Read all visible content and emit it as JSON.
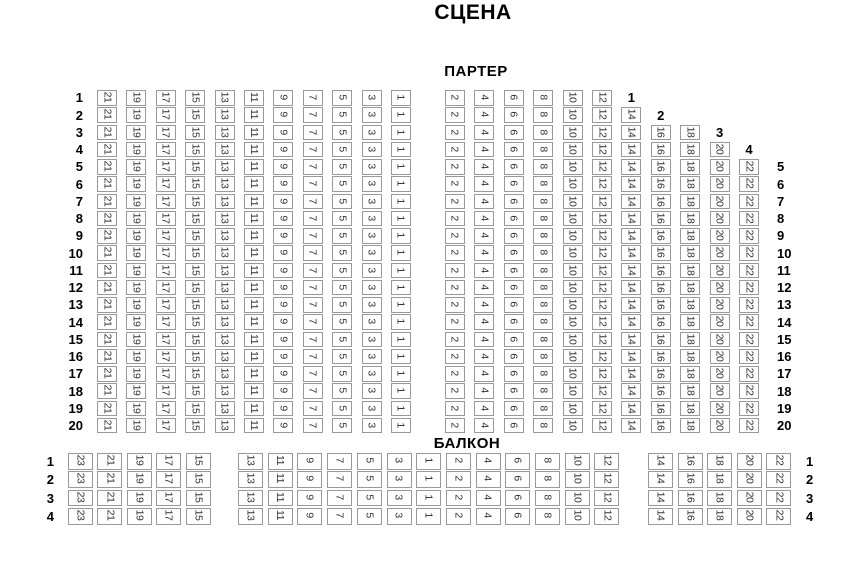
{
  "stage": {
    "label": "СЦЕНА"
  },
  "parterre": {
    "label": "ПАРТЕР",
    "left_row_labels": [
      "1",
      "2",
      "3",
      "4",
      "5",
      "6",
      "7",
      "8",
      "9",
      "10",
      "11",
      "12",
      "13",
      "14",
      "15",
      "16",
      "17",
      "18",
      "19",
      "20"
    ],
    "right_row_labels": [
      "5",
      "6",
      "7",
      "8",
      "9",
      "10",
      "11",
      "12",
      "13",
      "14",
      "15",
      "16",
      "17",
      "18",
      "19",
      "20"
    ],
    "left_block": {
      "columns": [
        "21",
        "19",
        "17",
        "15",
        "13",
        "11",
        "9",
        "7",
        "5",
        "3",
        "1"
      ],
      "rows_from": 1,
      "rows_to": 20
    },
    "right_block": {
      "columns": [
        {
          "seat": "2",
          "from_row": 1
        },
        {
          "seat": "4",
          "from_row": 1
        },
        {
          "seat": "6",
          "from_row": 1
        },
        {
          "seat": "8",
          "from_row": 1
        },
        {
          "seat": "10",
          "from_row": 1
        },
        {
          "seat": "12",
          "from_row": 1
        },
        {
          "seat": "14",
          "from_row": 2
        },
        {
          "seat": "16",
          "from_row": 3
        },
        {
          "seat": "18",
          "from_row": 3
        },
        {
          "seat": "20",
          "from_row": 4
        },
        {
          "seat": "22",
          "from_row": 5
        }
      ],
      "rows_to": 20
    },
    "inline_row_labels": [
      {
        "label": "1",
        "column_index": 6,
        "row": 1
      },
      {
        "label": "2",
        "column_index": 7,
        "row": 2
      },
      {
        "label": "3",
        "column_index": 9,
        "row": 3
      },
      {
        "label": "4",
        "column_index": 10,
        "row": 4
      }
    ]
  },
  "balcony": {
    "label": "БАЛКОН",
    "rows_from": 1,
    "rows_to": 4,
    "left_row_labels": [
      "1",
      "2",
      "3",
      "4"
    ],
    "right_row_labels": [
      "1",
      "2",
      "3",
      "4"
    ],
    "groups": [
      {
        "columns": [
          "23",
          "21",
          "19",
          "17",
          "15"
        ]
      },
      {
        "columns": [
          "13",
          "11",
          "9",
          "7",
          "5",
          "3",
          "1",
          "2",
          "4",
          "6",
          "8",
          "10",
          "12"
        ]
      },
      {
        "columns": [
          "14",
          "16",
          "18",
          "20",
          "22"
        ]
      }
    ]
  },
  "colors": {
    "background": "#ffffff",
    "seat_border": "#999999",
    "seat_number": "#333333",
    "label_text": "#000000"
  }
}
